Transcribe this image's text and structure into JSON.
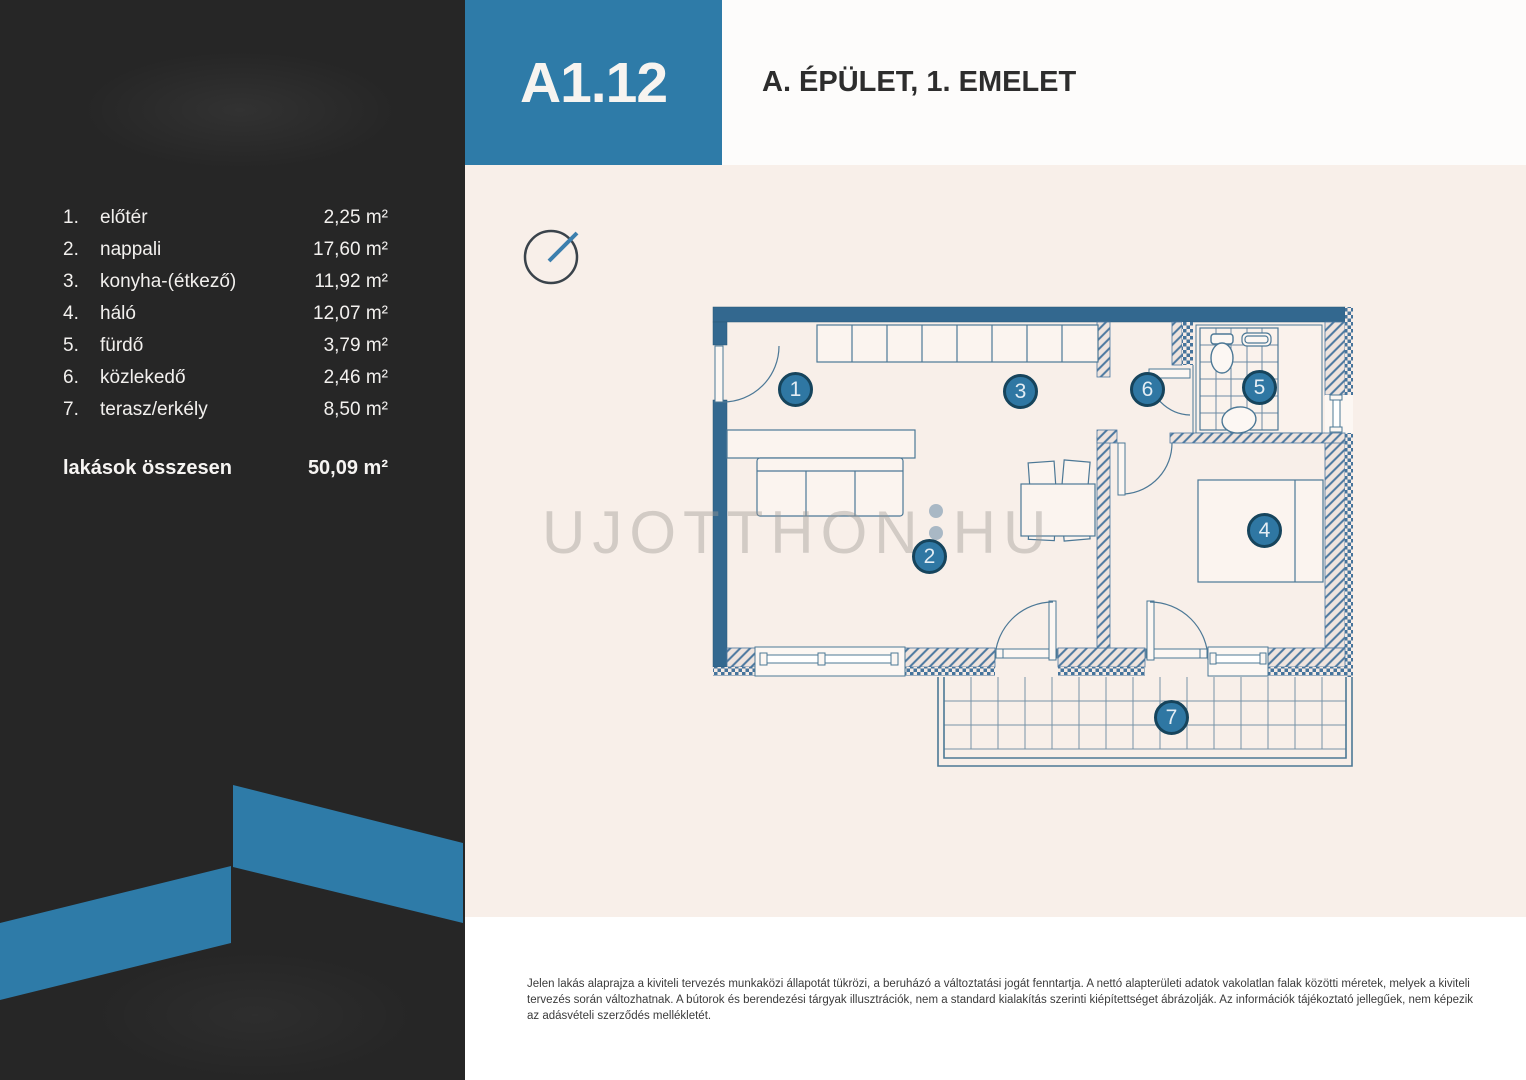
{
  "header": {
    "unit_code": "A1.12",
    "building_floor": "A. ÉPÜLET, 1. EMELET"
  },
  "room_list": {
    "rows": [
      {
        "num": "1.",
        "name": "előtér",
        "area": "2,25 m²"
      },
      {
        "num": "2.",
        "name": "nappali",
        "area": "17,60 m²"
      },
      {
        "num": "3.",
        "name": "konyha-(étkező)",
        "area": "11,92 m²"
      },
      {
        "num": "4.",
        "name": "háló",
        "area": "12,07 m²"
      },
      {
        "num": "5.",
        "name": "fürdő",
        "area": "3,79 m²"
      },
      {
        "num": "6.",
        "name": "közlekedő",
        "area": "2,46 m²"
      },
      {
        "num": "7.",
        "name": "terasz/erkély",
        "area": "8,50 m²"
      }
    ],
    "total_label": "lakások összesen",
    "total_value": "50,09 m²"
  },
  "plan": {
    "badges": [
      "1",
      "2",
      "3",
      "4",
      "5",
      "6",
      "7"
    ]
  },
  "watermark": {
    "left": "UJOTTHON",
    "right": "HU"
  },
  "footer": {
    "disclaimer": "Jelen lakás alaprajza a kiviteli tervezés munkaközi állapotát tükrözi, a beruházó a változtatási jogát fenntartja. A nettó alapterületi adatok vakolatlan falak közötti méretek, melyek a kiviteli tervezés során változhatnak. A bútorok és berendezési tárgyak illusztrációk, nem a standard kialakítás szerinti kiépítettséget ábrázolják. Az információk tájékoztató jellegűek, nem képezik az adásvételi szerződés mellékletét."
  },
  "colors": {
    "accent_blue": "#2e7ba8",
    "sidebar_dark": "#262626",
    "wall_blue": "#33688f",
    "plan_line": "#4c7896",
    "main_background": "#f8efe9",
    "badge_fill": "#2f77a3",
    "badge_ring": "#16445c"
  }
}
